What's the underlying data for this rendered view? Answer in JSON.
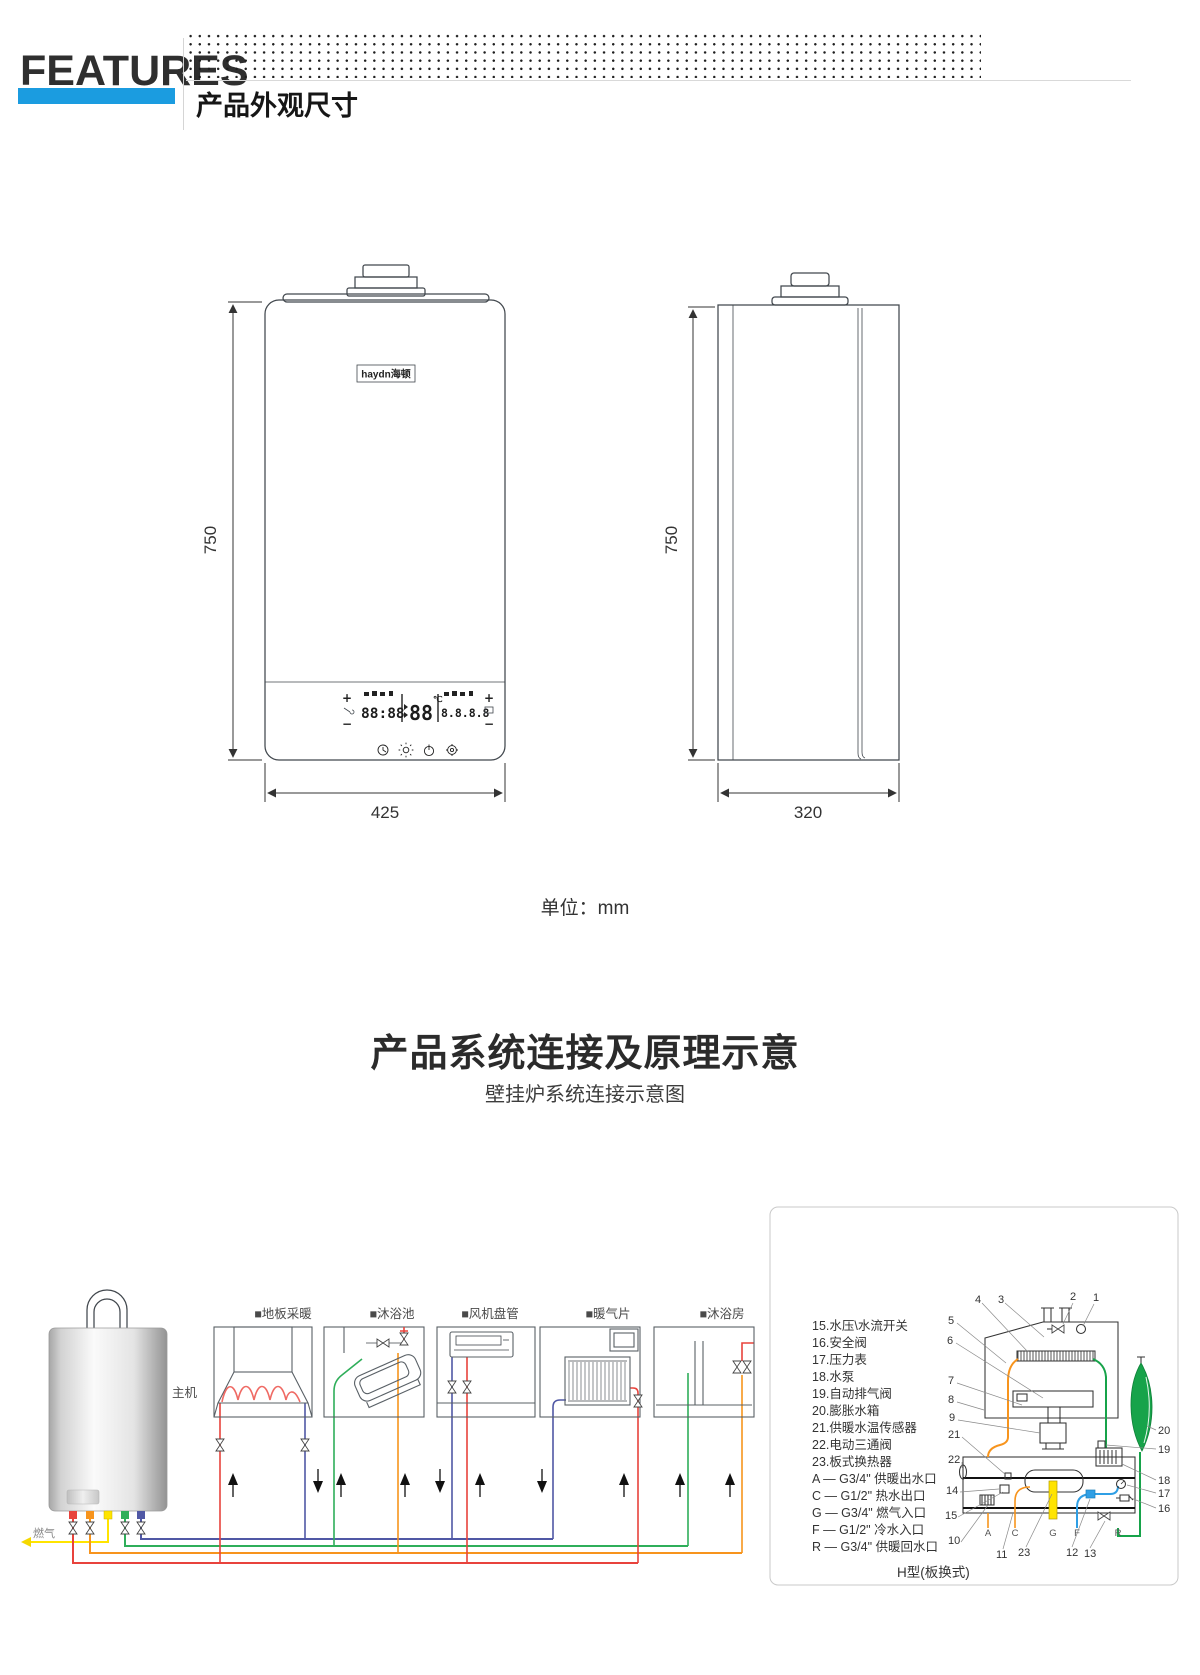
{
  "header": {
    "brand": "FEATURES",
    "section_title": "产品外观尺寸"
  },
  "outline": {
    "front_height": "750",
    "front_width": "425",
    "side_height": "750",
    "side_width": "320",
    "unit_note": "单位：mm",
    "logo": "haydn海顿",
    "lcd": {
      "left_value": "88:88",
      "center_value": "88",
      "center_unit": "℃",
      "right_value": "8.8.8.8",
      "plus": "+",
      "minus": "−"
    }
  },
  "system": {
    "title": "产品系统连接及原理示意",
    "subtitle": "壁挂炉系统连接示意图",
    "main_unit_label": "主机",
    "gas_label": "燃气",
    "appliance_labels": [
      "■地板采暖",
      "■沐浴池",
      "■风机盘管",
      "■暖气片",
      "■沐浴房"
    ],
    "schematic": {
      "parts_list": [
        "15.水压\\水流开关",
        "16.安全阀",
        "17.压力表",
        "18.水泵",
        "19.自动排气阀",
        "20.膨胀水箱",
        "21.供暖水温传感器",
        "22.电动三通阀",
        "23.板式换热器",
        "A — G3/4\" 供暖出水口",
        "C — G1/2\" 热水出口",
        "G — G3/4\" 燃气入口",
        "F — G1/2\" 冷水入口",
        "R — G3/4\" 供暖回水口"
      ],
      "caption": "H型(板换式)",
      "ports": [
        "A",
        "C",
        "G",
        "F",
        "R"
      ],
      "callouts": {
        "top": [
          "4",
          "3",
          "2",
          "1"
        ],
        "left": [
          "5",
          "6",
          "7",
          "8",
          "9",
          "21",
          "22",
          "14",
          "15",
          "10"
        ],
        "right": [
          "20",
          "19",
          "18",
          "17",
          "16"
        ],
        "bottom": [
          "11",
          "23",
          "12",
          "13"
        ]
      }
    }
  },
  "colors": {
    "accent_blue": "#1b9ce0",
    "pipe_red": "#e8433c",
    "pipe_orange": "#f7941d",
    "pipe_yellow": "#ffe400",
    "pipe_green": "#2fae5a",
    "pipe_navy": "#5058a5",
    "pipe_blue": "#2f9fe5",
    "tank_green": "#17a34a"
  }
}
